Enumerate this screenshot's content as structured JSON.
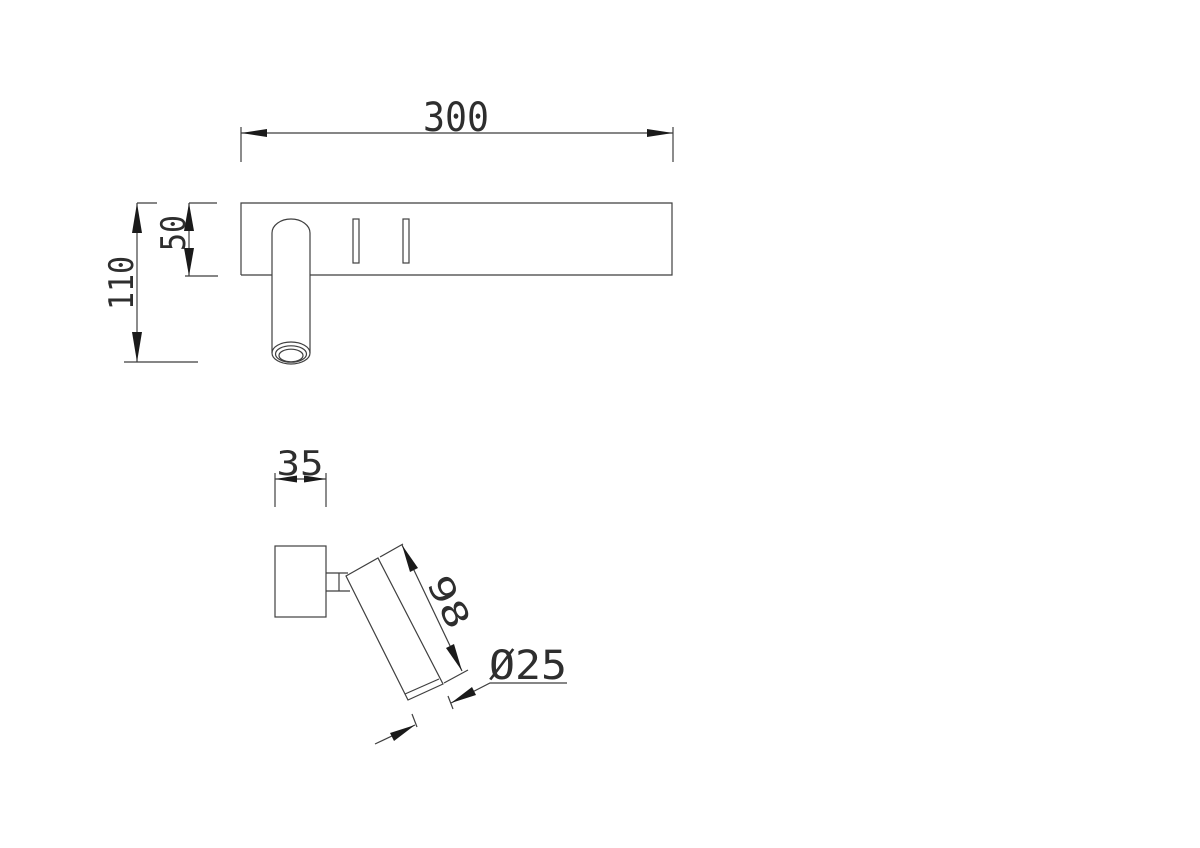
{
  "colors": {
    "background": "#ffffff",
    "line": "#3f3f3f",
    "arrow": "#1a1a1a",
    "text": "#2e2e2e"
  },
  "views": {
    "front": {
      "dimensions": {
        "plate_width": "300",
        "overall_height": "110",
        "plate_height": "50"
      }
    },
    "side": {
      "dimensions": {
        "plate_depth": "35",
        "barrel_length": "98",
        "barrel_diameter": "Ø25"
      }
    }
  }
}
